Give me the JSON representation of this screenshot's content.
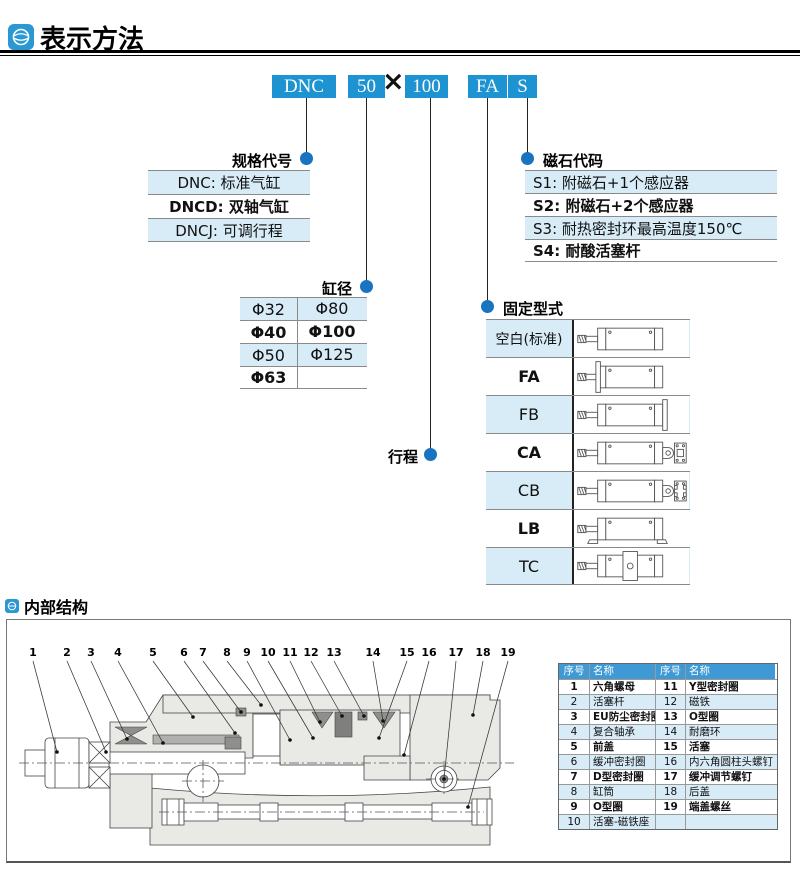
{
  "header": {
    "title": "表示方法"
  },
  "section2": {
    "title": "内部结构"
  },
  "model_code": {
    "segments": [
      "DNC",
      "50",
      "100",
      "FA",
      "S"
    ],
    "multiply": "×"
  },
  "labels": {
    "spec_code": "规格代号",
    "bore": "缸径",
    "stroke": "行程",
    "magnet_code": "磁石代码",
    "mounting_type": "固定型式"
  },
  "spec_codes": {
    "rows": [
      "DNC: 标准气缸",
      "DNCD: 双轴气缸",
      "DNCJ: 可调行程"
    ]
  },
  "bore_table": {
    "rows": [
      [
        "Φ32",
        "Φ80"
      ],
      [
        "Φ40",
        "Φ100"
      ],
      [
        "Φ50",
        "Φ125"
      ],
      [
        "Φ63",
        ""
      ]
    ]
  },
  "magnet_codes": {
    "rows": [
      "S1: 附磁石+1个感应器",
      "S2: 附磁石+2个感应器",
      "S3: 耐热密封环最高温度150℃",
      "S4: 耐酸活塞杆"
    ]
  },
  "mounting_types": {
    "rows": [
      {
        "code": "空白(标准)",
        "variant": "std"
      },
      {
        "code": "FA",
        "variant": "fa"
      },
      {
        "code": "FB",
        "variant": "fb"
      },
      {
        "code": "CA",
        "variant": "ca"
      },
      {
        "code": "CB",
        "variant": "cb"
      },
      {
        "code": "LB",
        "variant": "lb"
      },
      {
        "code": "TC",
        "variant": "tc"
      }
    ]
  },
  "parts_table": {
    "headers": [
      "序号",
      "名称",
      "序号",
      "名称"
    ],
    "rows": [
      [
        "1",
        "六角螺母",
        "11",
        "Y型密封圈"
      ],
      [
        "2",
        "活塞杆",
        "12",
        "磁铁"
      ],
      [
        "3",
        "EU防尘密封圈",
        "13",
        "O型圈"
      ],
      [
        "4",
        "复合轴承",
        "14",
        "耐磨环"
      ],
      [
        "5",
        "前盖",
        "15",
        "活塞"
      ],
      [
        "6",
        "缓冲密封圈",
        "16",
        "内六角圆柱头螺钉"
      ],
      [
        "7",
        "D型密封圈",
        "17",
        "缓冲调节螺钉"
      ],
      [
        "8",
        "缸筒",
        "18",
        "后盖"
      ],
      [
        "9",
        "O型圈",
        "19",
        "端盖螺丝"
      ],
      [
        "10",
        "活塞-磁铁座",
        "",
        ""
      ]
    ]
  },
  "diagram": {
    "callouts": [
      "1",
      "2",
      "3",
      "4",
      "5",
      "6",
      "7",
      "8",
      "9",
      "10",
      "11",
      "12",
      "13",
      "14",
      "15",
      "16",
      "17",
      "18",
      "19"
    ]
  },
  "colors": {
    "accent_blue": "#1e93d2",
    "dot_blue": "#1873c0",
    "row_blue": "#d8ecf8",
    "table_header_blue": "#3e99d4"
  }
}
